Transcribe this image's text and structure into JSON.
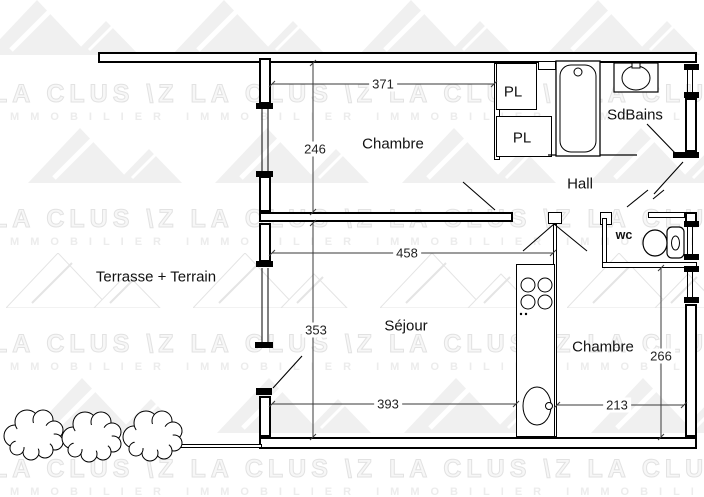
{
  "watermark": {
    "brand": "LA CLUS",
    "mark": "\\Z",
    "sub": "IMMOBILIER"
  },
  "rooms": {
    "chambre1": "Chambre",
    "chambre2": "Chambre",
    "sejour": "Séjour",
    "hall": "Hall",
    "sdbains": "SdBains",
    "wc": "wc",
    "pl1": "PL",
    "pl2": "PL",
    "terrasse": "Terrasse + Terrain"
  },
  "dimensions": {
    "d371": "371",
    "d246": "246",
    "d458": "458",
    "d353": "353",
    "d393": "393",
    "d213": "213",
    "d266": "266"
  },
  "icons": {
    "bathtub": "bathtub-icon",
    "washbasin": "washbasin-icon",
    "toilet": "toilet-icon",
    "cooktop": "cooktop-icon",
    "kitchen_sink": "kitchen-sink-icon",
    "bush": "bush-icon",
    "door_swing": "door-swing-line",
    "window": "window-symbol"
  },
  "colors": {
    "line": "#000000",
    "dimension_line": "#3a3a3a",
    "watermark_gray": "#e2e2e2",
    "background": "#ffffff"
  }
}
